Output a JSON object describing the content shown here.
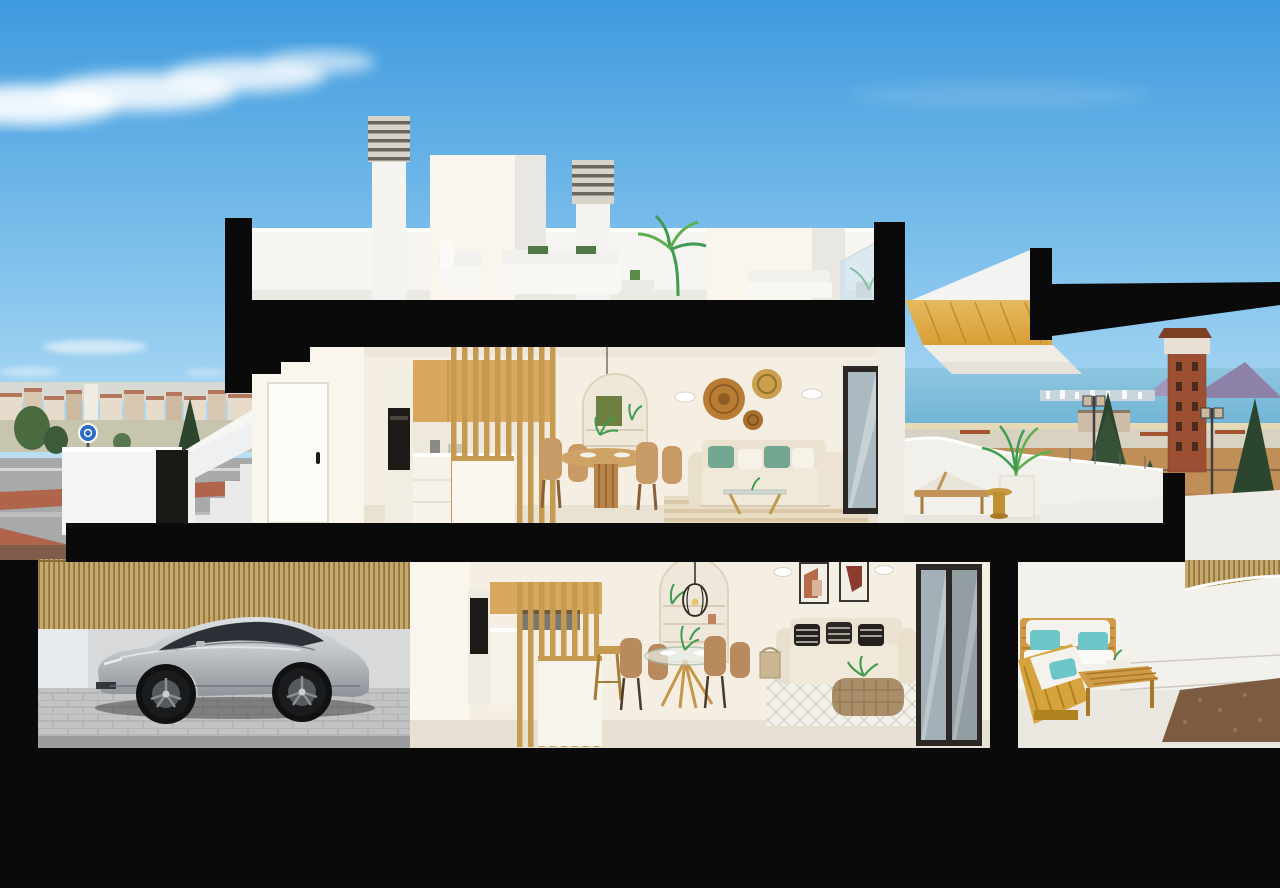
{
  "meta": {
    "type": "architectural-cutaway-render",
    "description": "Photorealistic 3D cross-section render of a two-storey coastal townhouse: roof terrace with chimneys and lounge furniture, furnished upper living floor with kitchen and terrace, lower floor with garage and silver sports car, living-dining area and rear terrace with wooden lounge set, set against a blue sky, town skyline, sea horizon and a brick watchtower."
  },
  "palette": {
    "sky_top": "#3e9ade",
    "sky_mid": "#8cc8ee",
    "sky_horizon": "#d8edf9",
    "cloud": "#ffffff",
    "cut_black": "#0a0a0a",
    "white_wall": "#f6f5f1",
    "white_shade": "#e9e7e1",
    "cream_wall": "#f5efe3",
    "cream_light": "#faf6ee",
    "floor_upper": "#e9e2d3",
    "floor_lower": "#e7e0d3",
    "wood": "#d9a85f",
    "wood_deep": "#c79a52",
    "stair_wood": "#d89f35",
    "outdoor_wood": "#cf9b48",
    "oven_black": "#1d1b18",
    "sofa_beige": "#ebe2d1",
    "pillow_green": "#74a791",
    "basket": "#b97c35",
    "glass": "#ccdfe8",
    "frame_dark": "#2a2724",
    "sea": "#71b4d6",
    "mountain": "#8f82a8",
    "dirt": "#c08f58",
    "road": "#a7a9aa",
    "red_path": "#b15c40",
    "tree_dark": "#2c452e",
    "tree_mid": "#4a6b40",
    "leaf": "#3f9b4f",
    "leaf_light": "#5cb052",
    "tower_brick": "#9c4f33",
    "fence_reed": "#c6a96c",
    "fence_line": "#a8843c",
    "car_silver": "#c0c4c9",
    "car_dark": "#8e9399",
    "car_glass": "#2c3138",
    "wheel": "#1a1b1d",
    "teal": "#6cc5c7",
    "terracotta": "#b86a4a",
    "paver": "#c2c3c4",
    "garage_wall": "#d7d9da",
    "rug_stripe": "#d9c9a8",
    "rug_white": "#f2f0ea",
    "town_roof": "#b2775d",
    "town_wall": "#e7dccb",
    "sign_blue": "#2a6cc8"
  },
  "scene": {
    "background": {
      "sky": "clear blue sky with wispy white clouds",
      "left": "town skyline with terracotta roofs, trees, grey road, red cycle path and roundabout sign",
      "right": "sea horizon with purple mountains, white shoreline city strip, brick watchtower, conifer trees, street lamps, dirt field and road"
    },
    "building": {
      "roof": [
        "louvered chimney left",
        "stair bulkhead volume",
        "louvered chimney right",
        "white lounge chair",
        "white outdoor sofa",
        "potted palm",
        "glass railing",
        "second lounge set"
      ],
      "upper_floor": [
        "white entry door",
        "kitchen with oven column and wood upper cabinets",
        "kitchen island",
        "wood slat partition",
        "round wood dining table with rattan chairs",
        "pendant lamp",
        "arched shelf niche",
        "wall sconces",
        "three woven basket wall plates",
        "beige sofa with green cushions",
        "glass coffee table",
        "striped jute rug",
        "dark framed sliding glass door",
        "terrace with curved parapet, sun lounger, mustard side table and potted palm",
        "wooden stair soffit"
      ],
      "lower_floor": [
        "garage with reed privacy fence",
        "silver sports car",
        "kitchen behind wood slats",
        "kitchen island with bar stool",
        "round glass dining table with four tan chairs",
        "arched niche with wire pendant lamp",
        "two framed abstract artworks",
        "beige sofa with black and white patterned cushions",
        "rattan basket coffee table",
        "white diamond-pattern rug",
        "black framed sliding glass doors",
        "terrace with wooden lounge set, white cushions and teal pillows",
        "gravel bed"
      ]
    },
    "cut_structure": "thick black section cuts through walls, floor slabs and ground"
  }
}
